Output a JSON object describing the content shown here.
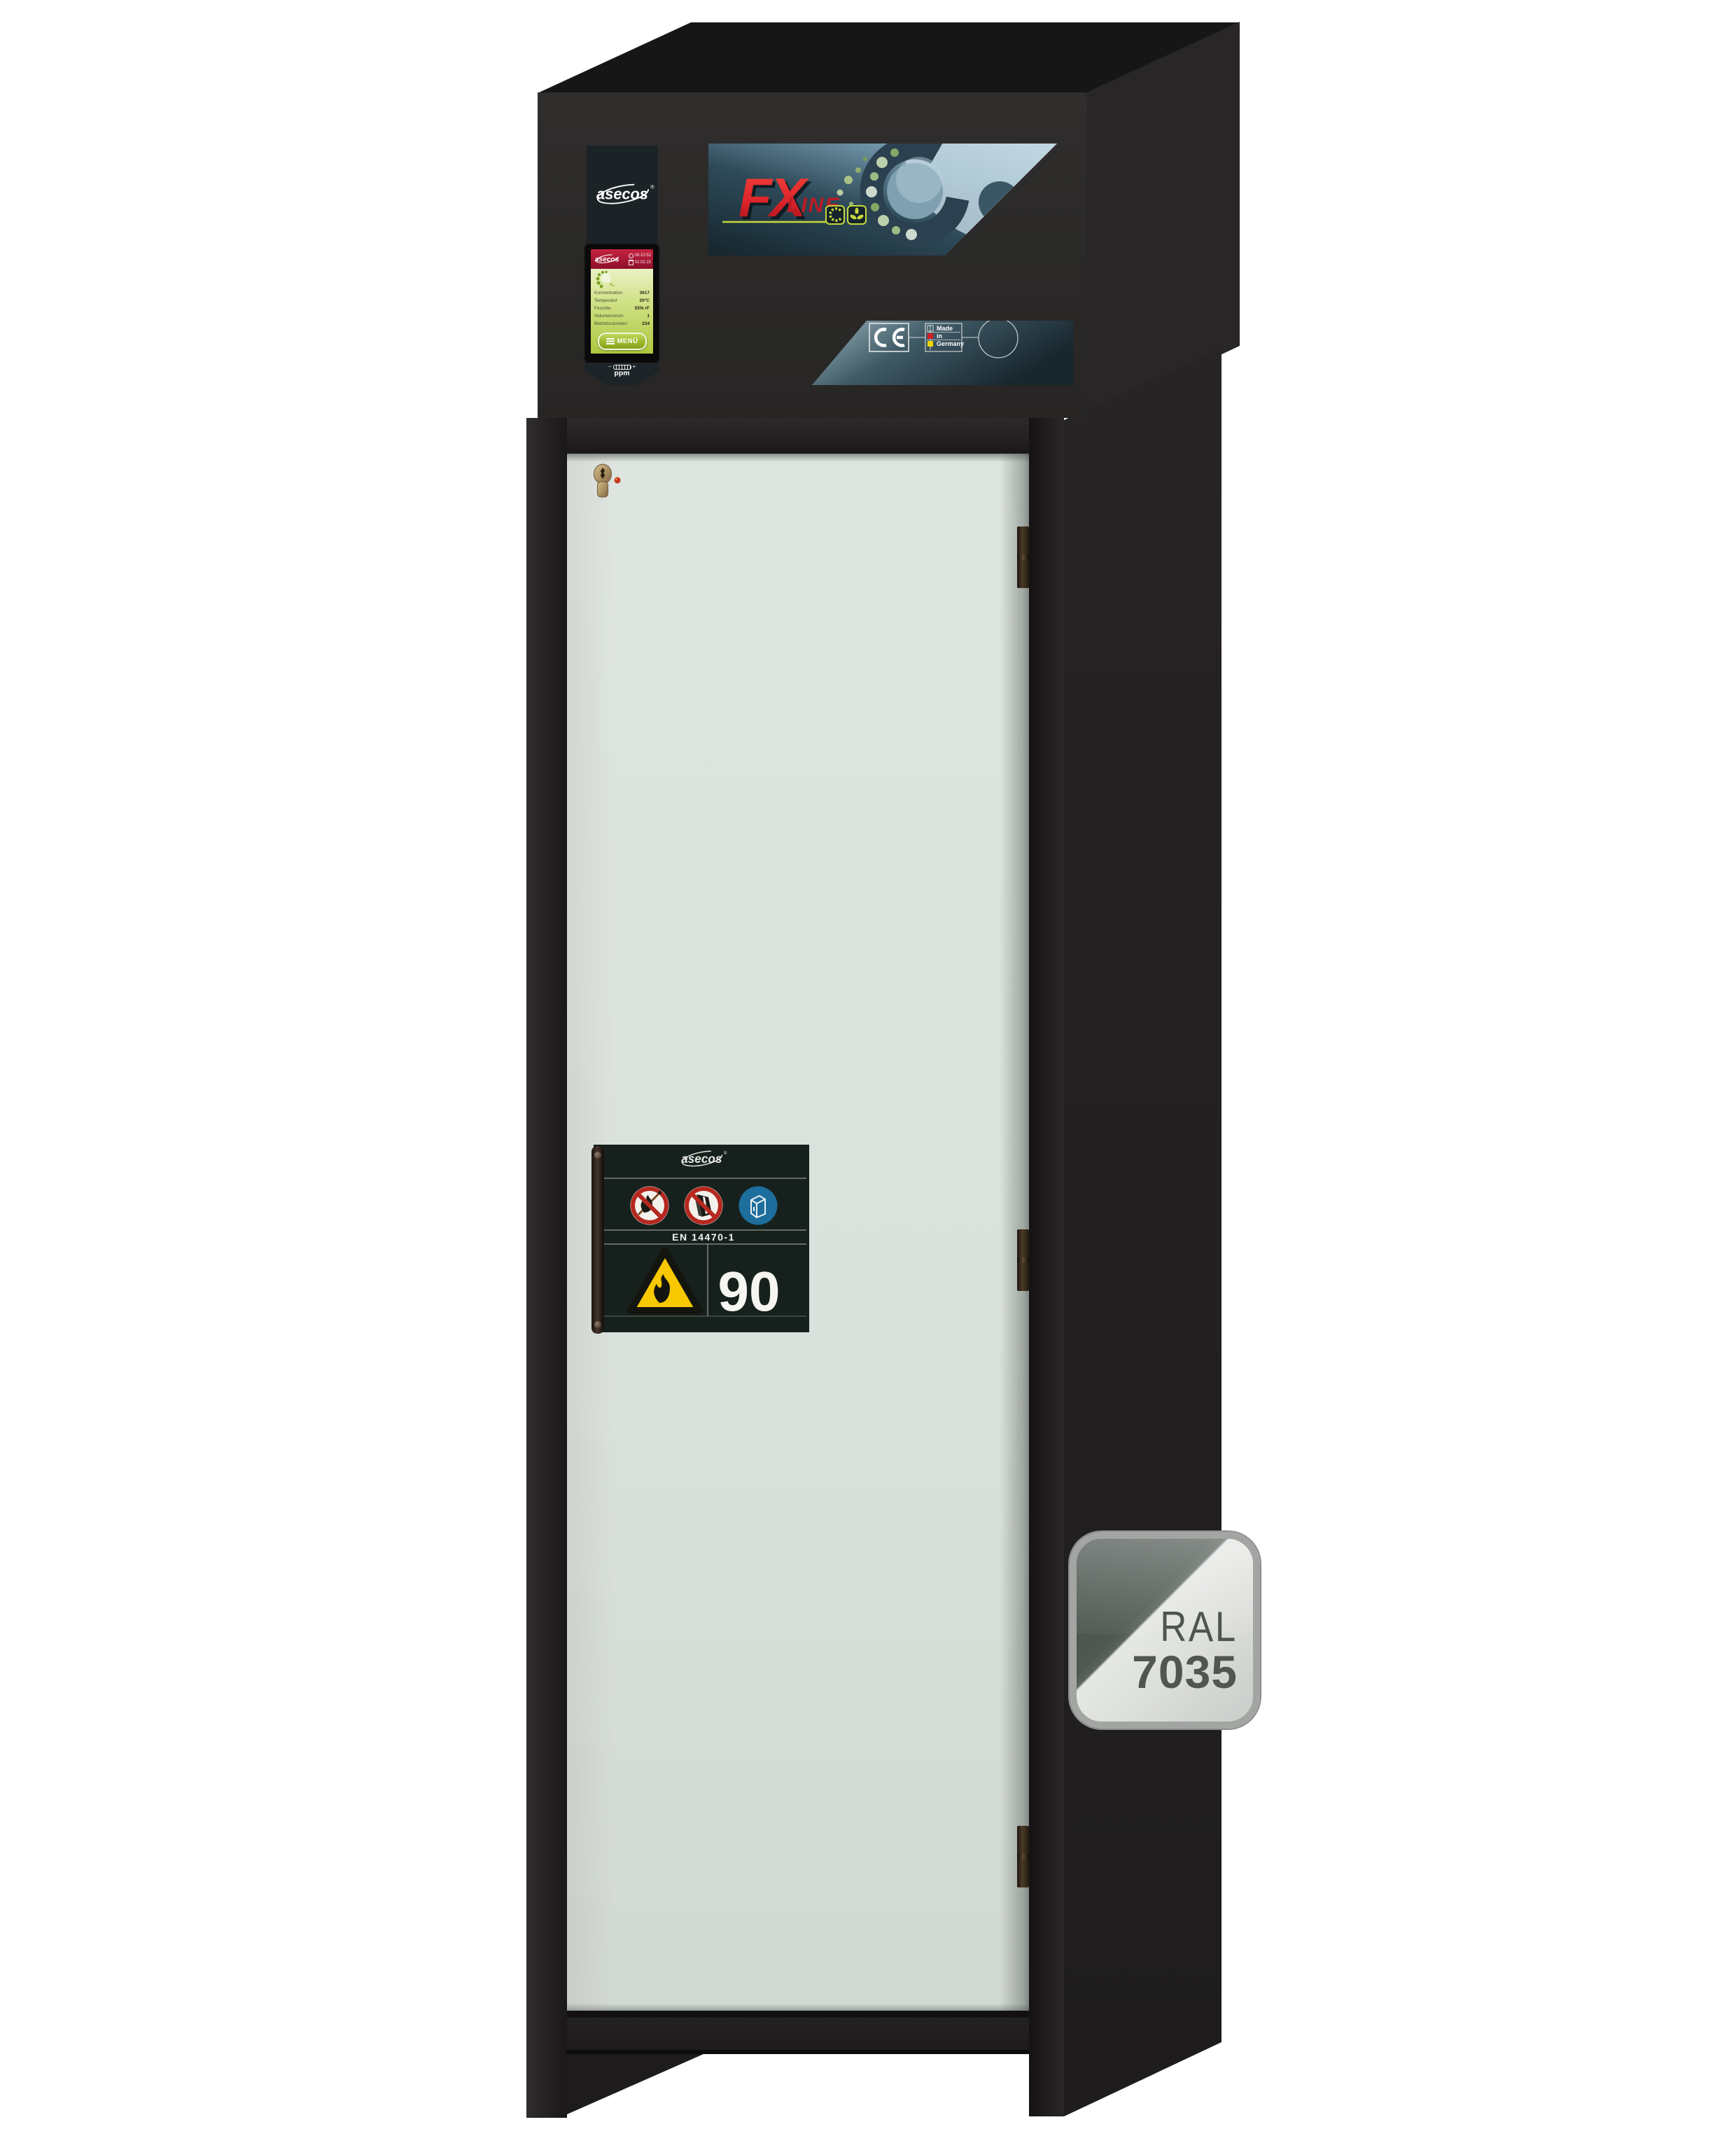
{
  "brand": {
    "name": "asecos",
    "reg": "®"
  },
  "top_unit": {
    "fx_logo": {
      "main": "FX",
      "sub": "LINE"
    },
    "display": {
      "time": "08:10:52",
      "date": "02.02.15",
      "rows": [
        {
          "label": "Konzentration",
          "value": "3617"
        },
        {
          "label": "Temperatur",
          "value": "20°C"
        },
        {
          "label": "Feuchte",
          "value": "55% rF"
        },
        {
          "label": "Volumenstrom",
          "value": "1"
        },
        {
          "label": "Betriebsstunden",
          "value": "234"
        }
      ],
      "menu_label": "MENÜ",
      "sensor_unit": "ppm",
      "minus": "−",
      "plus": "+"
    },
    "ce": {
      "mark": "CE",
      "made_in": [
        "Made",
        "in",
        "Germany"
      ]
    }
  },
  "door": {
    "label": {
      "standard": "EN 14470-1",
      "rating": "90",
      "signs": [
        "no-open-flames",
        "no-obstructing-or-storing",
        "keep-cabinet-closed"
      ]
    }
  },
  "ral_badge": {
    "line1": "RAL",
    "line2": "7035"
  },
  "colors": {
    "door_gray": "#dbe1dc",
    "frame_black": "#232021",
    "housing_charcoal": "#2b2a29",
    "accent_red": "#d8232a",
    "accent_lime": "#c6d93c",
    "panel_teal_dark": "#1b2b33",
    "panel_teal_light": "#a7c3d2",
    "screen_green": "#bcd455",
    "screen_header_red": "#b01d38",
    "mandatory_blue": "#1d6e9d",
    "warning_yellow": "#f7c600",
    "flag_red": "#d11f26",
    "flag_yellow": "#f2d500",
    "ral_light_gray": "#dfe1de",
    "ral_dark_gray": "#4b544e"
  }
}
